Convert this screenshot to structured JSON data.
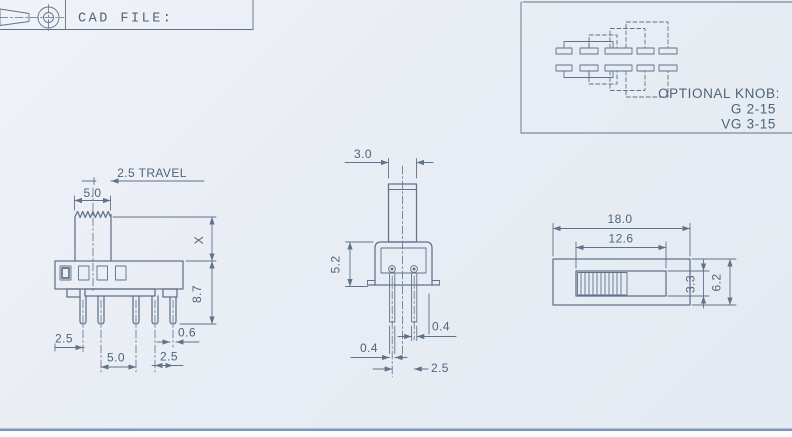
{
  "colors": {
    "line": "#5f7289",
    "text": "#4f6379",
    "paper": "#e9edf4",
    "bar": "#7e96b8",
    "below_bar": "#fafbfd"
  },
  "title_block": {
    "cad_file_label": "CAD FILE:"
  },
  "optional_knob_panel": {
    "heading": "OPTIONAL KNOB:",
    "row1_code": "G",
    "row1_size": "2-15",
    "row2_code": "VG",
    "row2_size": "3-15"
  },
  "side_view": {
    "travel_label": "2.5 TRAVEL",
    "knob_width": "5.0",
    "stem_height": "X",
    "body_height": "8.7",
    "pin_spacing_left": "2.5",
    "pin_spacing_center": "5.0",
    "pin_spacing_right": "2.5",
    "terminal_width": "0.6"
  },
  "front_view": {
    "knob_width": "3.0",
    "body_height": "5.2",
    "terminal_thickness_left": "0.4",
    "terminal_thickness_right": "0.4",
    "terminal_spacing": "2.5"
  },
  "top_view": {
    "body_length": "18.0",
    "slot_length": "12.6",
    "slot_width": "3.3",
    "body_width": "6.2"
  }
}
